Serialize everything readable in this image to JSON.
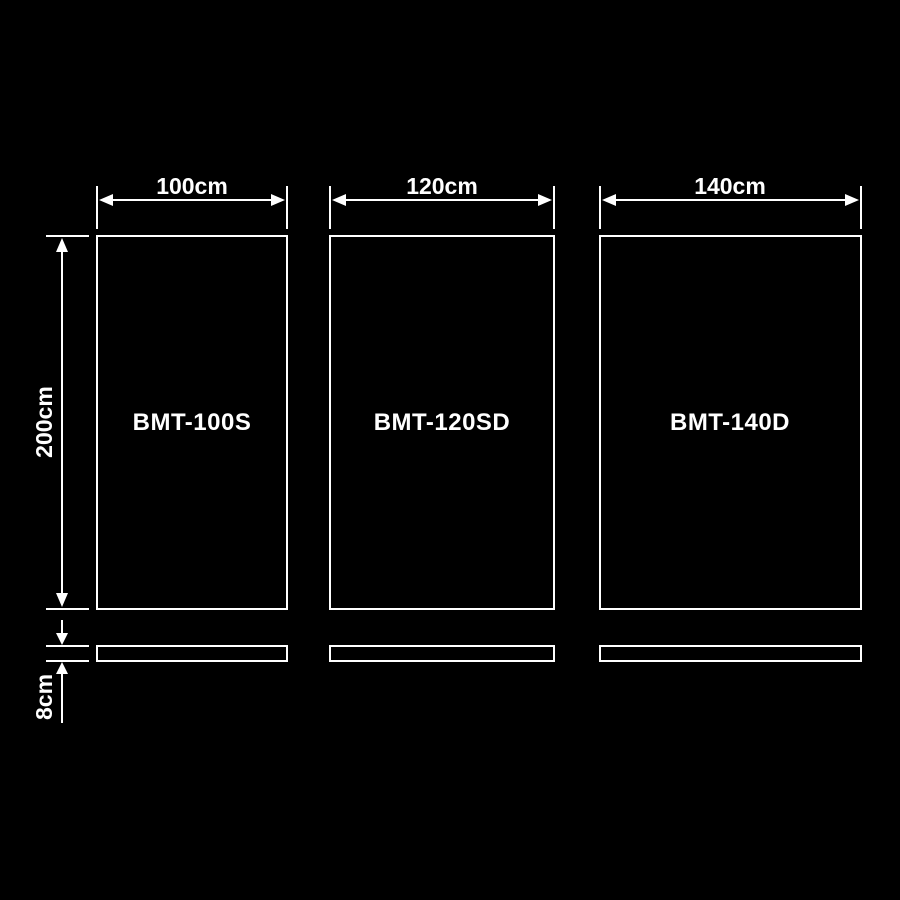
{
  "diagram": {
    "description": "size-comparison-dimension-diagram",
    "background_color": "#000000",
    "line_color": "#ffffff",
    "panels": [
      {
        "model": "BMT-100S",
        "width_label": "100cm"
      },
      {
        "model": "BMT-120SD",
        "width_label": "120cm"
      },
      {
        "model": "BMT-140D",
        "width_label": "140cm"
      }
    ],
    "height_label": "200cm",
    "base_thickness_label": "8cm"
  }
}
